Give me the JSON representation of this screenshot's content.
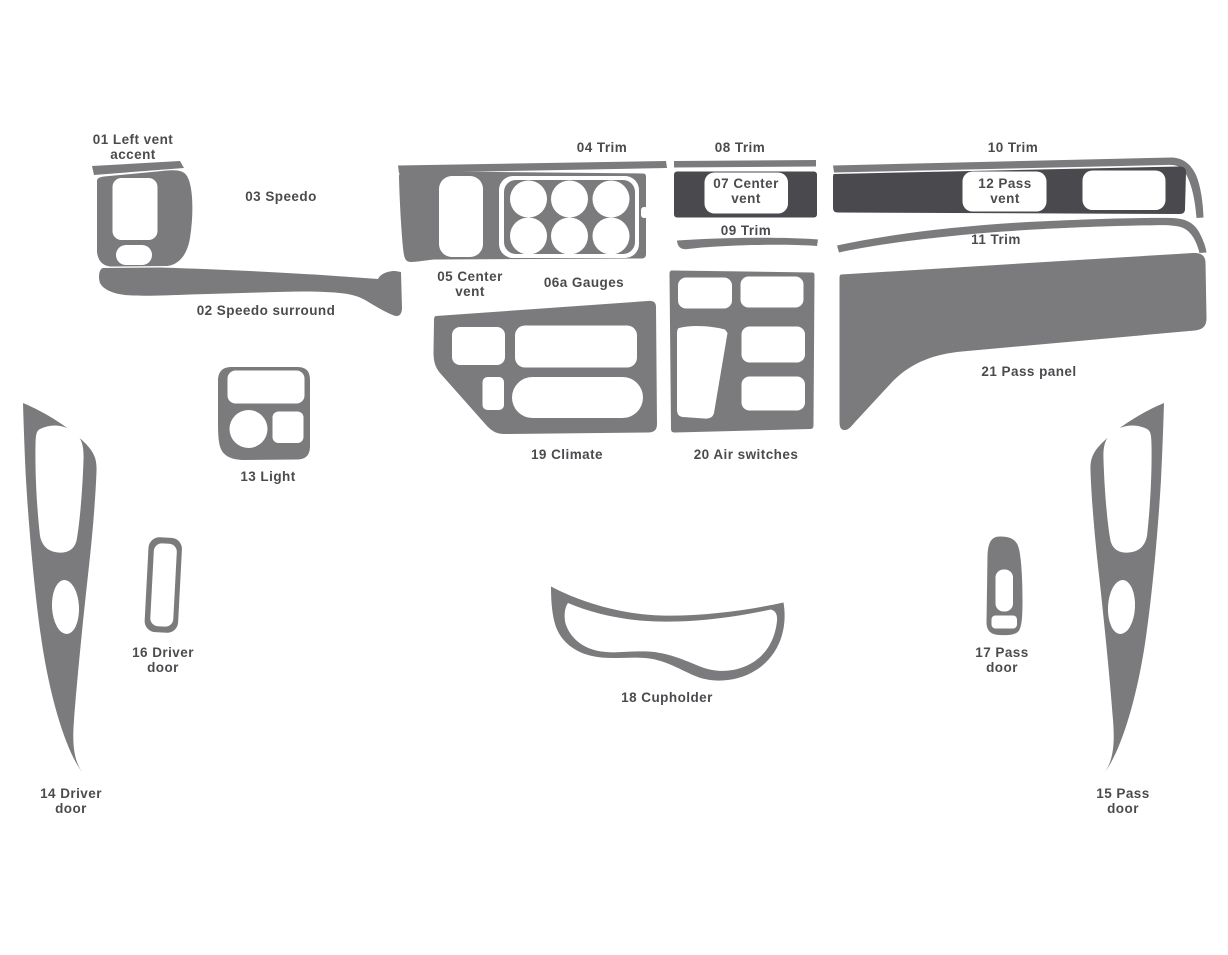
{
  "diagram": {
    "kind": "dash-trim-kit-parts-diagram",
    "background_color": "#ffffff",
    "part_fill_color": "#7b7b7d",
    "dark_part_fill_color": "#4a494d",
    "label_text_color": "#3c3b3f",
    "callout_box_color": "#ffffff",
    "parts": {
      "p01": {
        "number": "01",
        "name": "Left vent accent",
        "label": "01 Left vent\naccent",
        "shade": "gray"
      },
      "p02": {
        "number": "02",
        "name": "Speedo surround",
        "label": "02 Speedo surround",
        "shade": "gray"
      },
      "p03": {
        "number": "03",
        "name": "Speedo",
        "label": "03 Speedo",
        "shade": "gray"
      },
      "p04": {
        "number": "04",
        "name": "Trim",
        "label": "04 Trim",
        "shade": "gray"
      },
      "p05": {
        "number": "05",
        "name": "Center vent",
        "label": "05 Center\nvent",
        "shade": "gray"
      },
      "p06a": {
        "number": "06a",
        "name": "Gauges",
        "label": "06a Gauges",
        "shade": "gray"
      },
      "p07": {
        "number": "07",
        "name": "Center vent",
        "label": "07 Center\nvent",
        "shade": "dark"
      },
      "p08": {
        "number": "08",
        "name": "Trim",
        "label": "08 Trim",
        "shade": "gray"
      },
      "p09": {
        "number": "09",
        "name": "Trim",
        "label": "09 Trim",
        "shade": "gray"
      },
      "p10": {
        "number": "10",
        "name": "Trim",
        "label": "10 Trim",
        "shade": "gray"
      },
      "p11": {
        "number": "11",
        "name": "Trim",
        "label": "11 Trim",
        "shade": "gray"
      },
      "p12": {
        "number": "12",
        "name": "Pass vent",
        "label": "12 Pass\nvent",
        "shade": "dark"
      },
      "p13": {
        "number": "13",
        "name": "Light",
        "label": "13 Light",
        "shade": "gray"
      },
      "p14": {
        "number": "14",
        "name": "Driver door",
        "label": "14 Driver\ndoor",
        "shade": "gray"
      },
      "p15": {
        "number": "15",
        "name": "Pass door",
        "label": "15 Pass\ndoor",
        "shade": "gray"
      },
      "p16": {
        "number": "16",
        "name": "Driver door",
        "label": "16 Driver\ndoor",
        "shade": "gray"
      },
      "p17": {
        "number": "17",
        "name": "Pass door",
        "label": "17 Pass\ndoor",
        "shade": "gray"
      },
      "p18": {
        "number": "18",
        "name": "Cupholder",
        "label": "18 Cupholder",
        "shade": "gray"
      },
      "p19": {
        "number": "19",
        "name": "Climate",
        "label": "19 Climate",
        "shade": "gray"
      },
      "p20": {
        "number": "20",
        "name": "Air switches",
        "label": "20 Air switches",
        "shade": "gray"
      },
      "p21": {
        "number": "21",
        "name": "Pass panel",
        "label": "21 Pass panel",
        "shade": "gray"
      }
    }
  }
}
